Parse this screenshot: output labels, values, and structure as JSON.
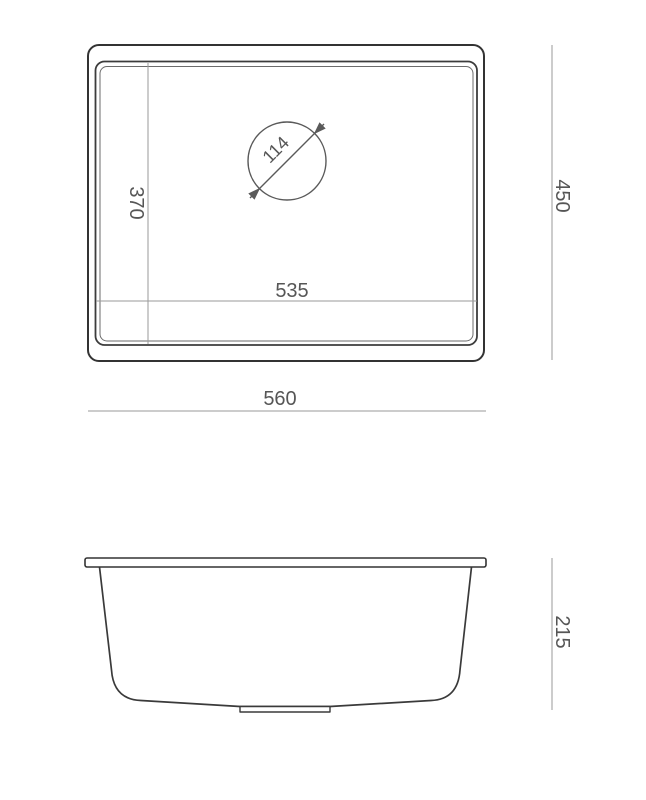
{
  "drawing": {
    "description": "Technical dimension drawing of a rectangular undermount kitchen sink, top view and front profile view",
    "colors": {
      "background": "#ffffff",
      "outline": "#333333",
      "dimension_line": "#9a9a9a",
      "label_text": "#565656"
    },
    "top_view": {
      "labels": {
        "outer_width": "560",
        "outer_height": "450",
        "inner_width": "535",
        "inner_height": "370",
        "drain_diameter": "114"
      }
    },
    "front_view": {
      "labels": {
        "height": "215"
      }
    }
  }
}
